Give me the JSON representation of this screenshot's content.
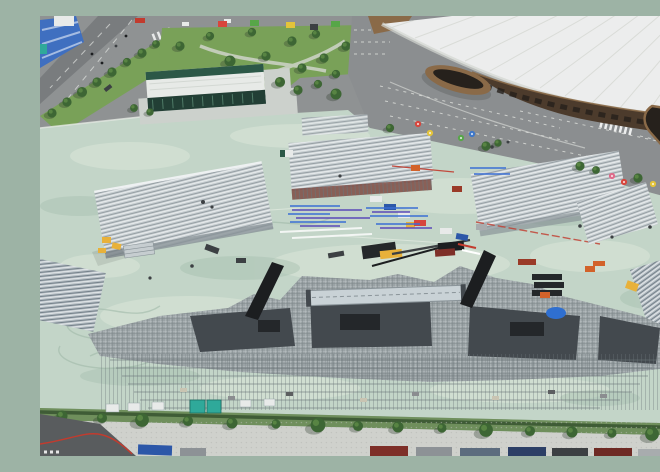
{
  "meta": {
    "type": "aerial-drone-photo",
    "description": "Aerial view of a large outdoor event venue under construction: silver scaffolding grandstands and a huge central stage structure rise from a pale mint-green field beside a white-domed indoor arena with bronze facade, parking lots with white stall markings, a landscaped park with colorful canopy tents, city roads at the top-left, and a tree-lined service road with parked container trucks along the bottom."
  },
  "scene": {
    "arena": {
      "label": "white-dome indoor arena"
    },
    "event_hall": {
      "label": "green glass event hall with white roof"
    },
    "park": {
      "label": "landscaped park with canopy tents"
    },
    "parking": {
      "label": "parking lots with white stall markings"
    },
    "field": {
      "label": "mint-green construction field"
    },
    "stage": {
      "label": "central stage scaffolding structure"
    },
    "grandstands": {
      "label": "temporary grandstand scaffolds",
      "count": 7
    },
    "service_road": {
      "label": "tree-lined service road with parked trucks"
    }
  },
  "colors": {
    "field": "#c3d5c8",
    "fieldLite": "#dde8da",
    "fieldDark": "#a9c2b1",
    "swirl": "#9db7a6",
    "scratch": "#eef3ea",
    "road": "#8f9293",
    "roadDark": "#797c7e",
    "asphalt": "#595c5e",
    "lane": "#e9ebe8",
    "grass": "#79a158",
    "grassDk": "#5d8145",
    "treeDark": "#3d6634",
    "treeLite": "#5d8a46",
    "shadow": "#2e3b2e",
    "path": "#cfd4c9",
    "curb": "#e4e8e2",
    "parking": "#8b8e90",
    "pline": "#dfe1dd",
    "domeRoof": "#eceded",
    "domeShade": "#d3d6d0",
    "domeSeam": "#d8dad5",
    "facade": "#4c3b2c",
    "bronze": "#8a6a48",
    "glassDk": "#26211c",
    "bldgRoof": "#e7eae7",
    "bldgGreen": "#2c5847",
    "bldgFace": "#223f35",
    "apron": "#ccd1cc",
    "scafBase": "#c6cdd0",
    "scafLite": "#eef1f2",
    "scafDark": "#8a9499",
    "scafBase2": "#b3bcc2",
    "scafDark2": "#6e7a84",
    "stage": "#9aa2a5",
    "stageDk": "#43494e",
    "deck": "#24272a",
    "truss": "#c9d2d6",
    "grid": "#e3e8e9",
    "gridDk": "#6a7478",
    "maroon": "#7e4a42",
    "redAccent": "#c23b2e",
    "crane": "#e8b13a",
    "orange": "#d2622a",
    "teal": "#2fa99a",
    "tarp": "#2f6fd0",
    "pipeBlue": "#3a6fd4",
    "pipeIndigo": "#5a4ab8",
    "contRed": "#7e2f28",
    "rust": "#9a3a28",
    "hoard": "#3f6fc0",
    "white": "#ffffff",
    "van": "#e8eae9",
    "hedge": "#3f5c36",
    "grassBand": "#6f8f5c",
    "walk": "#cfd1cc",
    "speck": "#b6b8b3",
    "trkBlue": "#2c57a8",
    "trkGray": "#8d9296",
    "trkSlate": "#5c6c7e",
    "trkNavy": "#2c3f66",
    "trkDk": "#3c4043",
    "trkRed": "#6e2a24",
    "trkSilver": "#a8acae",
    "black": "#1c1e20",
    "umbRed": "#d8453c",
    "umbYellow": "#e3c43a",
    "umbGreen": "#57a648",
    "umbPink": "#e06a8a",
    "umbBlue": "#3d77c9"
  }
}
